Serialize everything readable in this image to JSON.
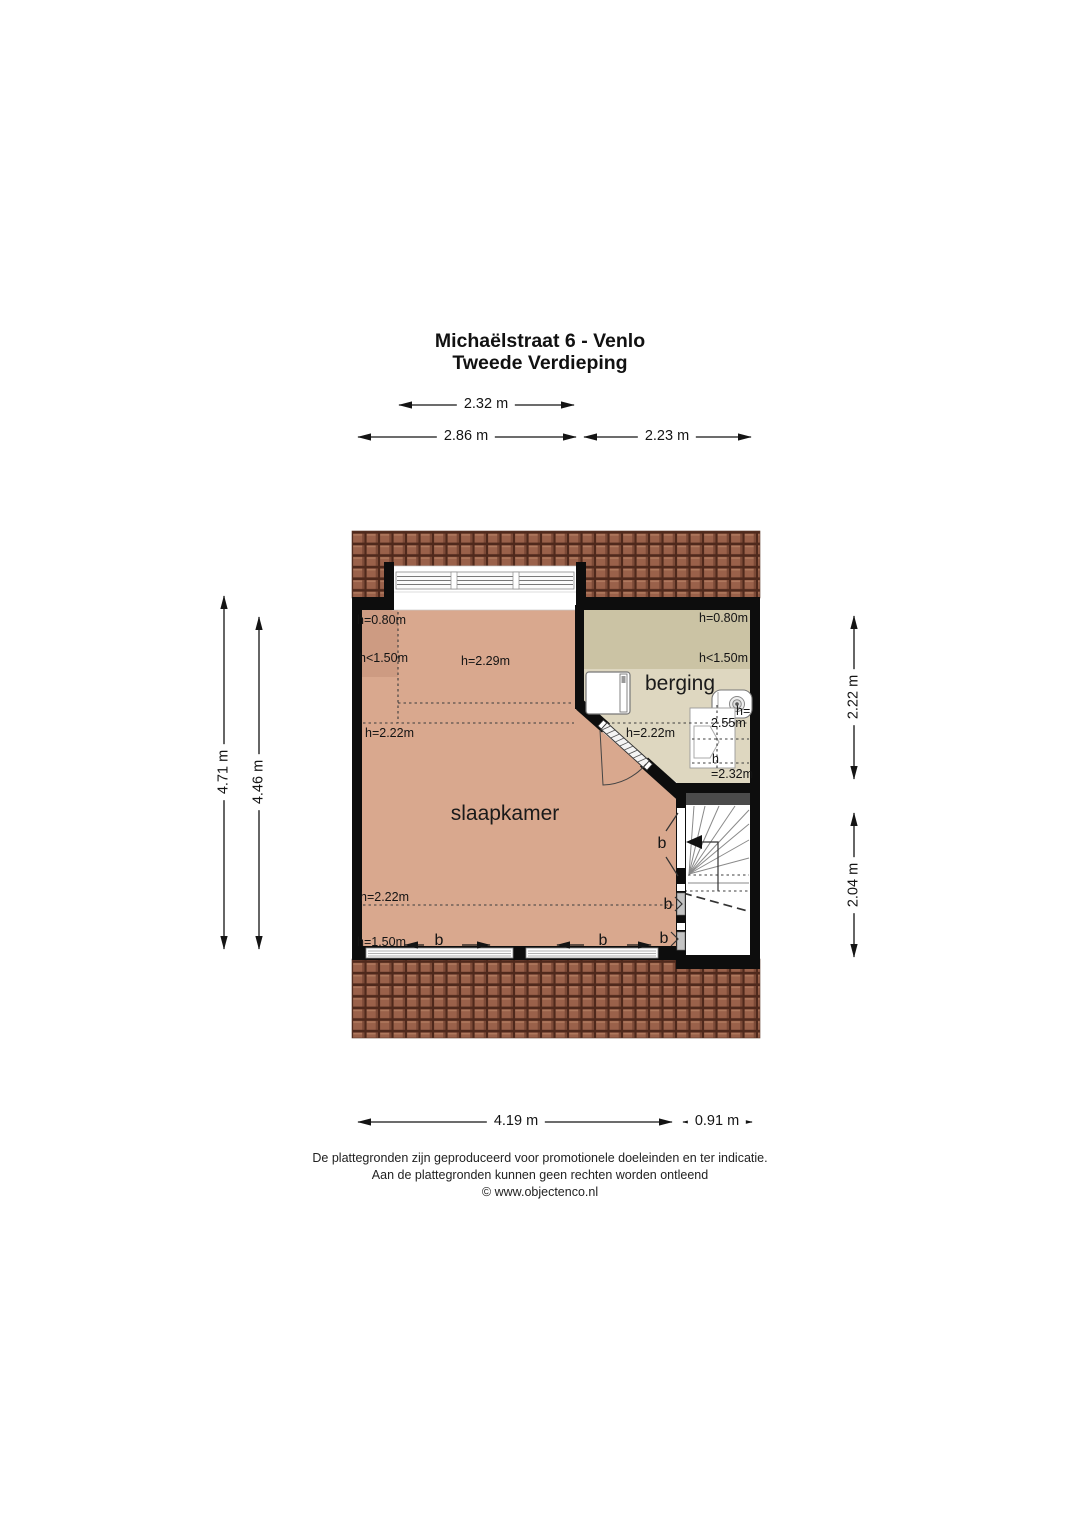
{
  "title": {
    "address": "Michaëlstraat 6 - Venlo",
    "floor": "Tweede Verdieping"
  },
  "dimensions": {
    "top_inner": "2.32 m",
    "top_left": "2.86 m",
    "top_right": "2.23 m",
    "left_outer": "4.71 m",
    "left_inner": "4.46 m",
    "right_upper": "2.22 m",
    "right_lower": "2.04 m",
    "bottom_main": "4.19 m",
    "bottom_stairs": "0.91 m"
  },
  "rooms": {
    "bedroom": {
      "name": "slaapkamer",
      "h080": "h=0.80m",
      "h150": "h<1.50m",
      "h229": "h=2.29m",
      "h222_upper": "h=2.22m",
      "h222_lower": "h=2.22m",
      "h150_sill": "h=1.50m"
    },
    "storage": {
      "name": "berging",
      "h080": "h=0.80m",
      "h150": "h<1.50m",
      "h222": "h=2.22m",
      "h255_prefix": "h=",
      "h255_value": "2.55m",
      "h232_prefix": "h",
      "h232_value": "=2.32m"
    }
  },
  "window_marks": {
    "label": "b"
  },
  "footer": {
    "line1": "De plattegronden zijn geproduceerd voor promotionele doeleinden en ter indicatie.",
    "line2": "Aan de plattegronden kunnen geen rechten worden ontleend",
    "line3": "© www.objectenco.nl"
  },
  "colors": {
    "bedroom_floor": "#d9a88e",
    "bedroom_floor_low": "#cd9b82",
    "storage_floor": "#ded7c0",
    "storage_floor_low": "#cbc3a4",
    "roof_base": "#9a614a",
    "roof_dark": "#4f291c",
    "wall": "#0d0d0d"
  }
}
